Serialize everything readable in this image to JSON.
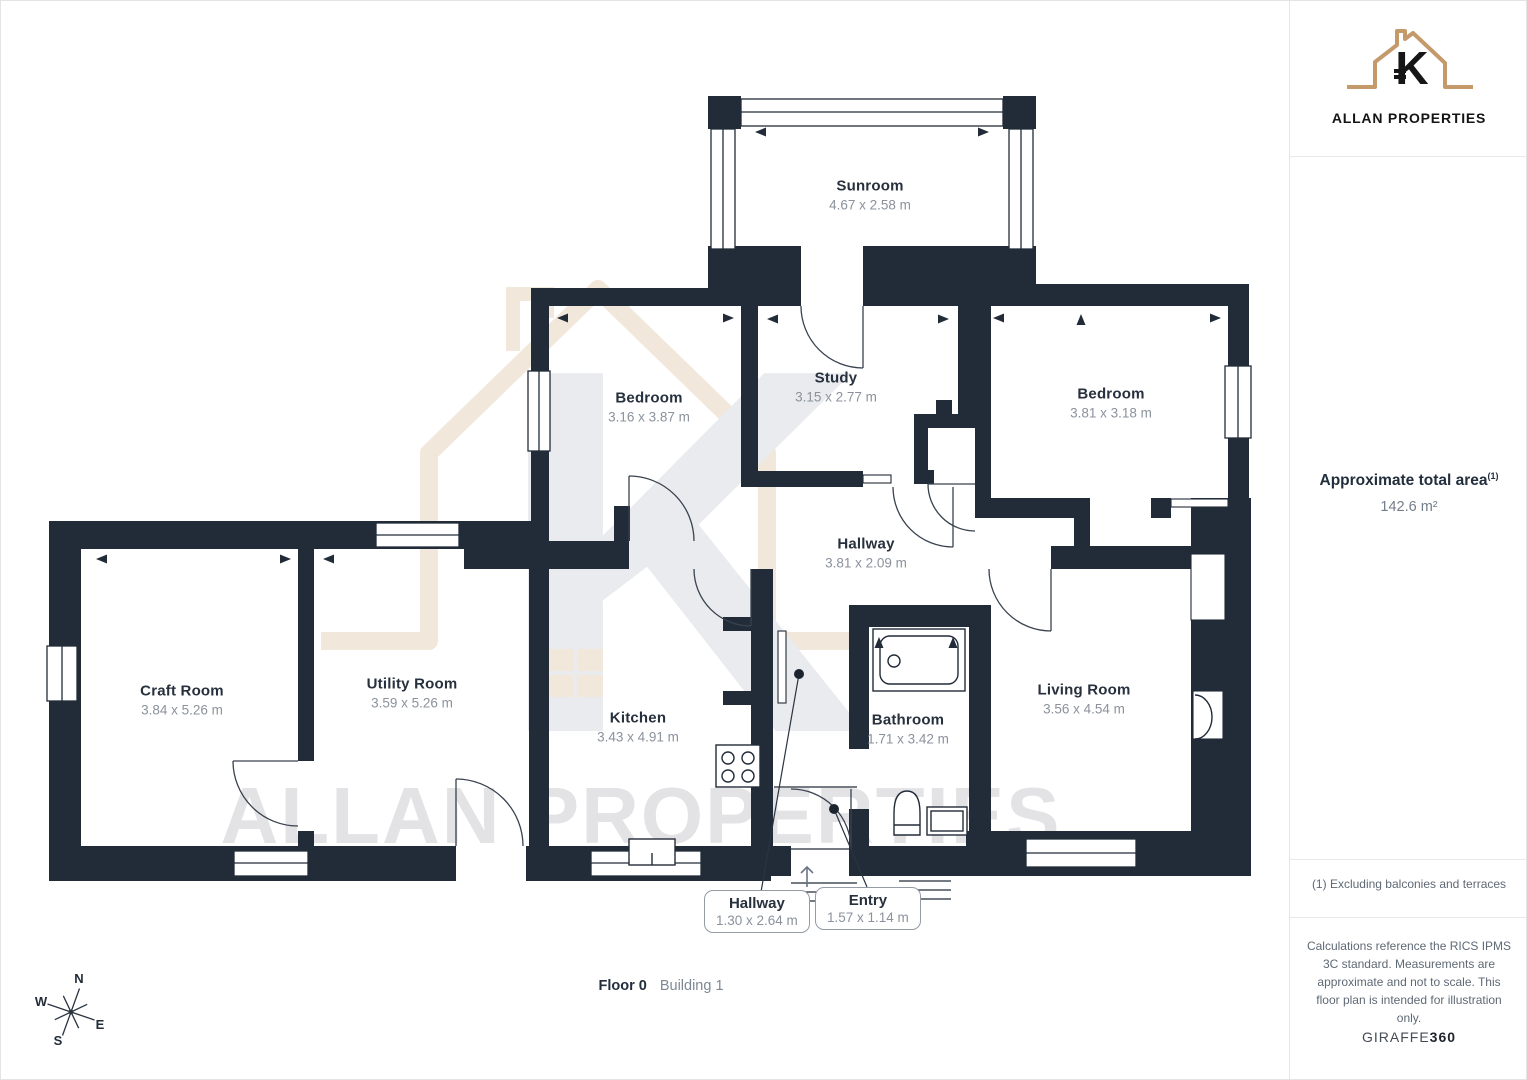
{
  "sidebar": {
    "logo": {
      "monogram": "K",
      "brand": "ALLAN PROPERTIES"
    },
    "area": {
      "label": "Approximate total area",
      "footnote_marker": "(1)",
      "value": "142.6 m²"
    },
    "footnote": "(1) Excluding balconies and terraces",
    "disclaimer": "Calculations reference the RICS IPMS 3C standard. Measurements are approximate and not to scale. This floor plan is intended for illustration only.",
    "credit": {
      "name": "GIRAFFE",
      "suffix": "360"
    }
  },
  "floor_plan": {
    "watermark_text": "ALLAN PROPERTIES",
    "rooms": [
      {
        "name": "Sunroom",
        "dimensions": "4.67 x 2.58 m"
      },
      {
        "name": "Bedroom",
        "dimensions": "3.16 x 3.87 m"
      },
      {
        "name": "Study",
        "dimensions": "3.15 x 2.77 m"
      },
      {
        "name": "Bedroom",
        "dimensions": "3.81 x 3.18 m"
      },
      {
        "name": "Hallway",
        "dimensions": "3.81 x 2.09 m"
      },
      {
        "name": "Craft Room",
        "dimensions": "3.84 x 5.26 m"
      },
      {
        "name": "Utility Room",
        "dimensions": "3.59 x 5.26 m"
      },
      {
        "name": "Kitchen",
        "dimensions": "3.43 x 4.91 m"
      },
      {
        "name": "Bathroom",
        "dimensions": "1.71 x 3.42 m"
      },
      {
        "name": "Living Room",
        "dimensions": "3.56 x 4.54 m"
      }
    ],
    "callouts": [
      {
        "name": "Hallway",
        "dimensions": "1.30 x 2.64 m"
      },
      {
        "name": "Entry",
        "dimensions": "1.57 x 1.14 m"
      }
    ],
    "floor_label": "Floor 0",
    "building_label": "Building 1",
    "compass": {
      "n": "N",
      "e": "E",
      "s": "S",
      "w": "W"
    }
  },
  "colors": {
    "wall": "#222c39",
    "label": "#27303d",
    "dimension": "#8b929c",
    "logo_tan": "#c49a6b",
    "watermark_beige": "#f1e7db",
    "watermark_gray": "#e5e6e9"
  }
}
